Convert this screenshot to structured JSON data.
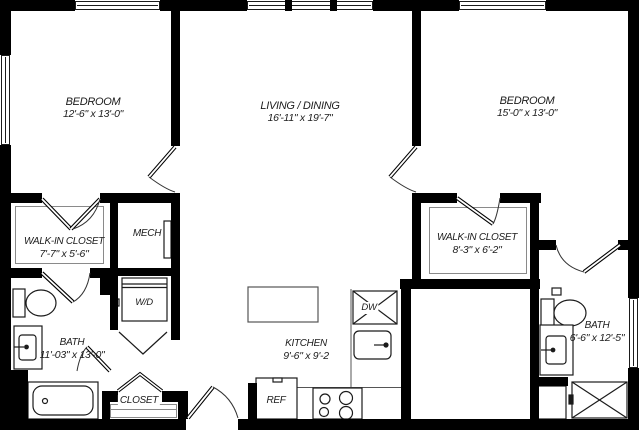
{
  "plan": {
    "title": "2 Bedroom 2 Bath Floor Plan",
    "colors": {
      "wall": "#000000",
      "background": "#ffffff",
      "fixture_line": "#1b1b1b",
      "thin_line": "#8a8a8a",
      "text": "#1c1c1c"
    },
    "rooms": [
      {
        "name": "BEDROOM",
        "dims": "12'-6\" x 13'-0\""
      },
      {
        "name": "LIVING / DINING",
        "dims": "16'-11\" x 19'-7\""
      },
      {
        "name": "BEDROOM",
        "dims": "15'-0\" x 13'-0\""
      },
      {
        "name": "WALK-IN CLOSET",
        "dims": "7'-7\" x 5'-6\""
      },
      {
        "name": "MECH",
        "dims": ""
      },
      {
        "name": "BATH",
        "dims": "11'-03\" x 13'-0\""
      },
      {
        "name": "CLOSET",
        "dims": ""
      },
      {
        "name": "KITCHEN",
        "dims": "9'-6\" x 9'-2"
      },
      {
        "name": "WALK-IN CLOSET",
        "dims": "8'-3\" x 6'-2\""
      },
      {
        "name": "BATH",
        "dims": "6'-6\" x 12'-5\""
      }
    ],
    "fixtures": [
      {
        "label": "W/D"
      },
      {
        "label": "REF"
      },
      {
        "label": "DW"
      }
    ]
  }
}
